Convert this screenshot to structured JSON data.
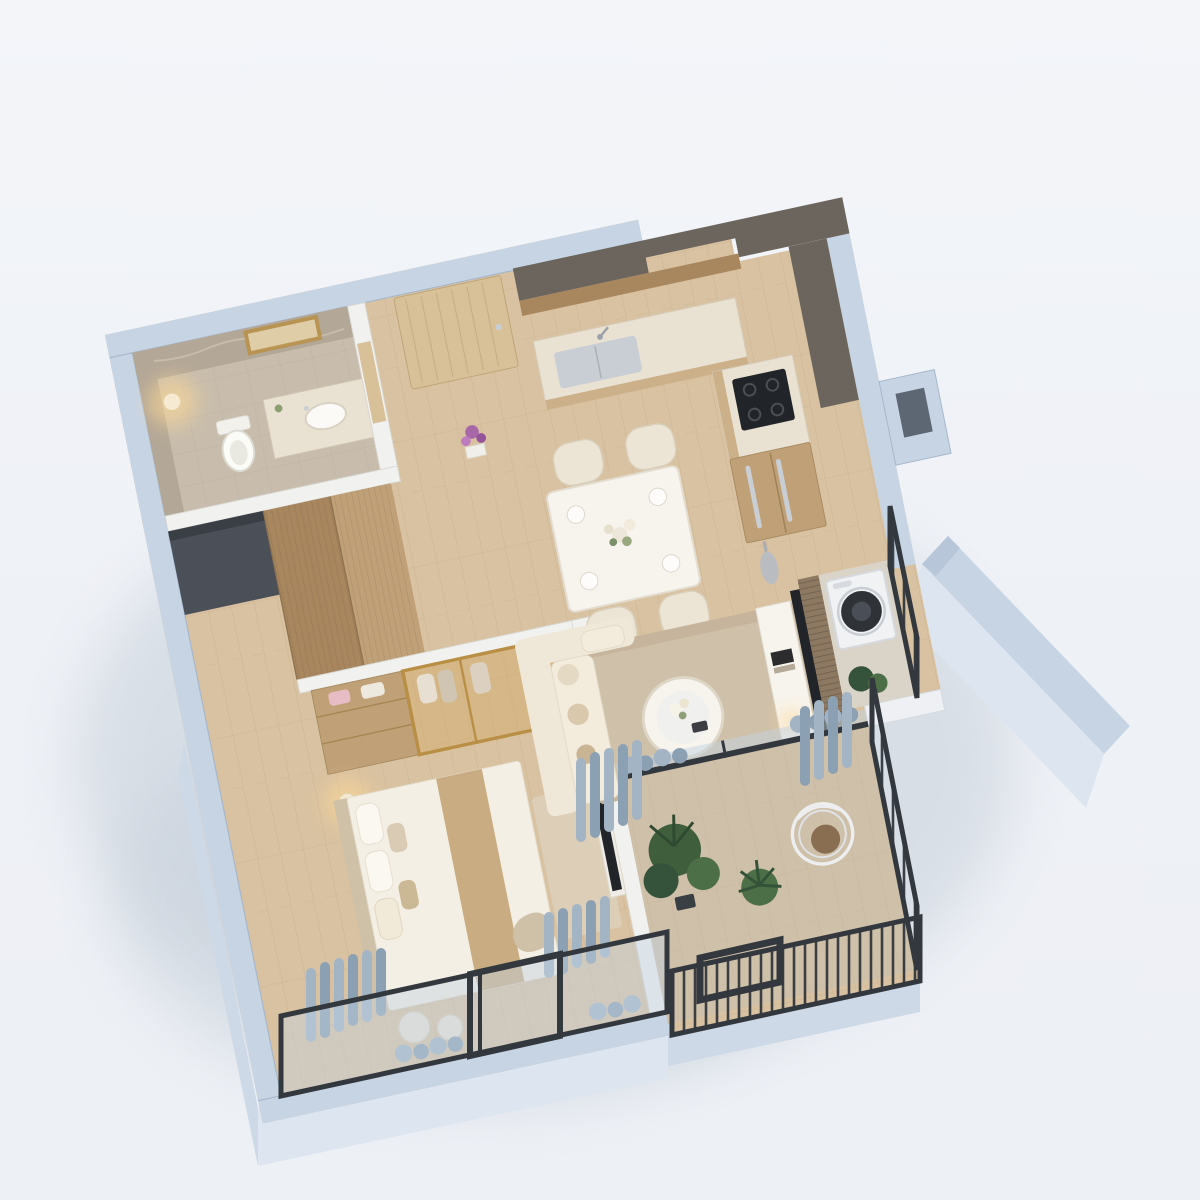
{
  "meta": {
    "type": "architectural-3d-floorplan-render",
    "view": "isometric-top-down-perspective",
    "subject": "one-bedroom-apartment-interior"
  },
  "palette": {
    "bgTop": "#f3f5f9",
    "bg": "#eef1f6",
    "bgBottom": "#edf0f5",
    "shadow": "#bfc9d4",
    "wallTop": "#c6d4e4",
    "wallEdge": "#a6b7cb",
    "wallFace": "#dde6f0",
    "wallFace2": "#cdd9e7",
    "innerWall": "#f1f1ef",
    "innerWallEdge": "#d9d9d4",
    "floorWood": "#d9c2a1",
    "floorWoodLine": "#c2a888",
    "floorBalcony": "#cfc0a9",
    "floorBath": "#c8bdac",
    "marble": "#e9e1d2",
    "marbleDark": "#b3a797",
    "counterFront": "#cbb089",
    "woodCabinet": "#c0a077",
    "woodDark": "#a8865e",
    "woodDoor": "#d8c099",
    "darkBand": "#6b655e",
    "steel": "#c9ced4",
    "black": "#212428",
    "railing": "#33383e",
    "glass": "#c3d3e2",
    "curtain": "#a3b4c5",
    "curtain2": "#8ba0b2",
    "sofa": "#efe8d9",
    "sofa2": "#f3ecdd",
    "rug": "#c6b59c",
    "rug2": "#cfc0a9",
    "white": "#f7f4ee",
    "cream": "#ece4d4",
    "creamEdge": "#d9cfba",
    "gold": "#b98f45",
    "goldGlass": "rgba(210,170,105,0.45)",
    "green1": "#3f5e3c",
    "green2": "#35523a",
    "green3": "#4d6f47",
    "lampGlow": "rgba(255,216,150,0.55)",
    "purple": "#a868a8",
    "silver": "#b9bdc2",
    "bedRunner": "#c9ac82",
    "bedLinen": "#f4efe4",
    "throw": "#cfc0a8",
    "washer": "#f0f2f4",
    "washerDoor": "#2f3237"
  },
  "scene": {
    "rooms": [
      {
        "name": "bathroom",
        "items": [
          "marble-tiled-walls",
          "backlit-mirror",
          "vanity-counter",
          "washbasin",
          "toilet",
          "floor-lamp",
          "purple-flowers",
          "wood-partition-door"
        ]
      },
      {
        "name": "entry",
        "items": [
          "wood-entry-door",
          "silver-door-handle"
        ]
      },
      {
        "name": "kitchen",
        "items": [
          "l-shaped-counter",
          "marble-countertop",
          "inset-steel-sink",
          "faucet",
          "dark-cooktop",
          "wood-panel-fridge",
          "steel-fridge-handles",
          "tall-wood-cabinets",
          "dark-cabinet-top-band",
          "service-shaft"
        ]
      },
      {
        "name": "dining-area",
        "items": [
          "white-dining-table",
          "cream-chair",
          "cream-chair",
          "cream-chair",
          "cream-chair",
          "place-settings",
          "flower-centerpiece"
        ]
      },
      {
        "name": "living-area",
        "items": [
          "l-shaped-sofa",
          "throw-pillows",
          "area-rug",
          "round-coffee-table",
          "flower-vase",
          "tv-panel",
          "wood-slat-partition",
          "white-media-console",
          "books",
          "table-lamp",
          "silver-floor-vase"
        ]
      },
      {
        "name": "laundry-balcony",
        "items": [
          "washing-machine",
          "potted-plant",
          "black-metal-railing"
        ]
      },
      {
        "name": "living-balcony",
        "items": [
          "sliding-glass-wall",
          "gray-curtains",
          "potted-plants",
          "hanging-egg-chair",
          "black-metal-railing"
        ]
      },
      {
        "name": "bedroom",
        "items": [
          "double-bed",
          "headboard",
          "pillows",
          "bed-runner",
          "throw-blanket",
          "floor-cushions",
          "gold-framed-glass-wardrobe",
          "wood-drawer-unit",
          "hanging-clothes",
          "bedside-lamp",
          "wall-tv",
          "blue-gray-curtains",
          "dark-framed-window-wall"
        ]
      },
      {
        "name": "hallway",
        "items": [
          "wood-wardrobe-panels",
          "dark-storage-niche"
        ]
      }
    ],
    "exterior": [
      "cut-wall-tops-blue-gray",
      "tall-neighbor-wall-slab",
      "soft-ground-shadow"
    ]
  }
}
